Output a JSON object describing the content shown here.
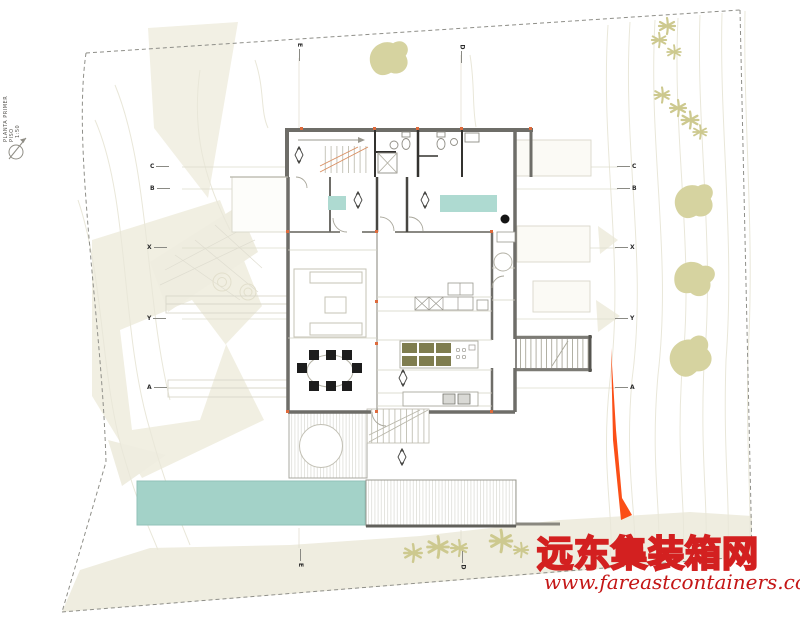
{
  "title_block": {
    "line1": "PLANTA PRIMER PISO",
    "line2": "1:50"
  },
  "grid": {
    "left": [
      "C",
      "B",
      "X",
      "Y",
      "A"
    ],
    "right": [
      "C",
      "B",
      "X",
      "Y",
      "A"
    ],
    "top": [
      "E",
      "D"
    ],
    "bottom": [
      "E",
      "D"
    ]
  },
  "watermark": {
    "site_name": "远东集装箱网",
    "site_url": "www.fareastcontainers.com"
  },
  "colors": {
    "pool_teal": "#a3d2c8",
    "bed_teal": "#aedad1",
    "tree_olive": "#d6d3a0",
    "palm_olive": "#cdc98f",
    "stool_olive": "#7f7d4f",
    "accent_orange": "#fb4f17",
    "watermark_red": "#d32020",
    "wall_gray": "#6e6d68"
  }
}
